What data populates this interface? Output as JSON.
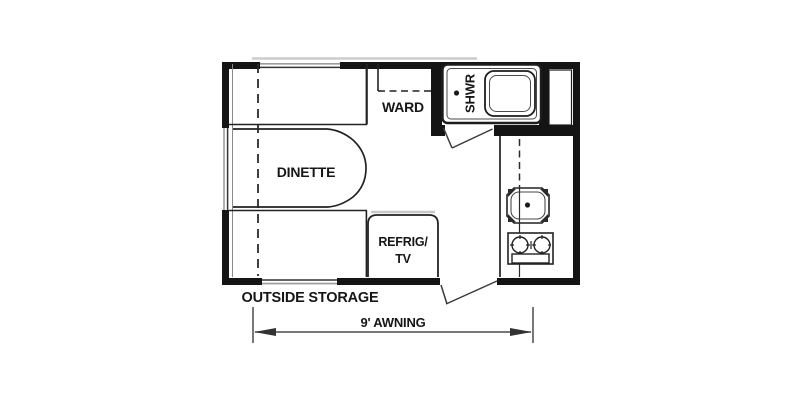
{
  "floorplan": {
    "labels": {
      "wardrobe": "WARD",
      "shower": "SHWR",
      "dinette": "DINETTE",
      "refrig_line1": "REFRIG/",
      "refrig_line2": "TV"
    },
    "annotations": {
      "outside_storage": "OUTSIDE STORAGE",
      "awning": "9' AWNING"
    },
    "colors": {
      "wall": "#141414",
      "line": "#2b2b2b",
      "window_gray": "#9b9b9b",
      "shadow_gray": "#c8c8c8",
      "background": "#ffffff"
    }
  }
}
